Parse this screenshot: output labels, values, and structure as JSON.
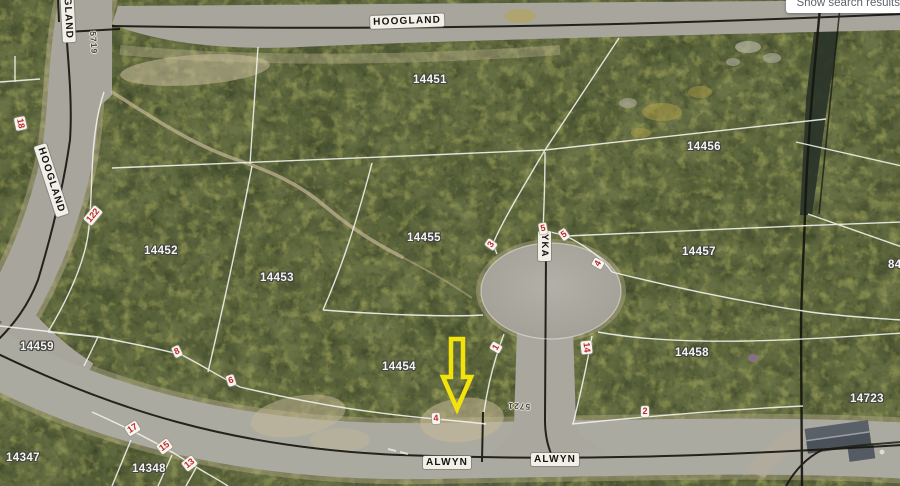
{
  "ui": {
    "search_results_button": "Show search results"
  },
  "map": {
    "streets": [
      {
        "label": "HOOGLAND"
      },
      {
        "label": "HOOGLAND"
      },
      {
        "label": "HOOGLAND"
      },
      {
        "label": "ALWYN"
      },
      {
        "label": "ALWYN"
      },
      {
        "label": "YKA"
      }
    ],
    "erf_annotations": [
      {
        "label": "5719"
      },
      {
        "label": "5721"
      }
    ],
    "parcels": [
      {
        "number": "14451"
      },
      {
        "number": "14456"
      },
      {
        "number": "14452"
      },
      {
        "number": "14453"
      },
      {
        "number": "14455"
      },
      {
        "number": "14457"
      },
      {
        "number": "14459"
      },
      {
        "number": "14454"
      },
      {
        "number": "14458"
      },
      {
        "number": "14723"
      },
      {
        "number": "14347"
      },
      {
        "number": "14348"
      },
      {
        "number": "84"
      }
    ],
    "lot_markers": [
      {
        "number": "18"
      },
      {
        "number": "122"
      },
      {
        "number": "5"
      },
      {
        "number": "5"
      },
      {
        "number": "3"
      },
      {
        "number": "4"
      },
      {
        "number": "1"
      },
      {
        "number": "14"
      },
      {
        "number": "8"
      },
      {
        "number": "6"
      },
      {
        "number": "4"
      },
      {
        "number": "2"
      },
      {
        "number": "17"
      },
      {
        "number": "15"
      },
      {
        "number": "13"
      }
    ],
    "highlight_arrow": {
      "points_to_parcel": "14454",
      "color": "#f2e40a"
    },
    "colors": {
      "marker_text": "#c22623",
      "boundary_line": "#f2f2ec",
      "cadastral_black": "#17170f",
      "parcel_label": "#f4f4f2"
    }
  }
}
